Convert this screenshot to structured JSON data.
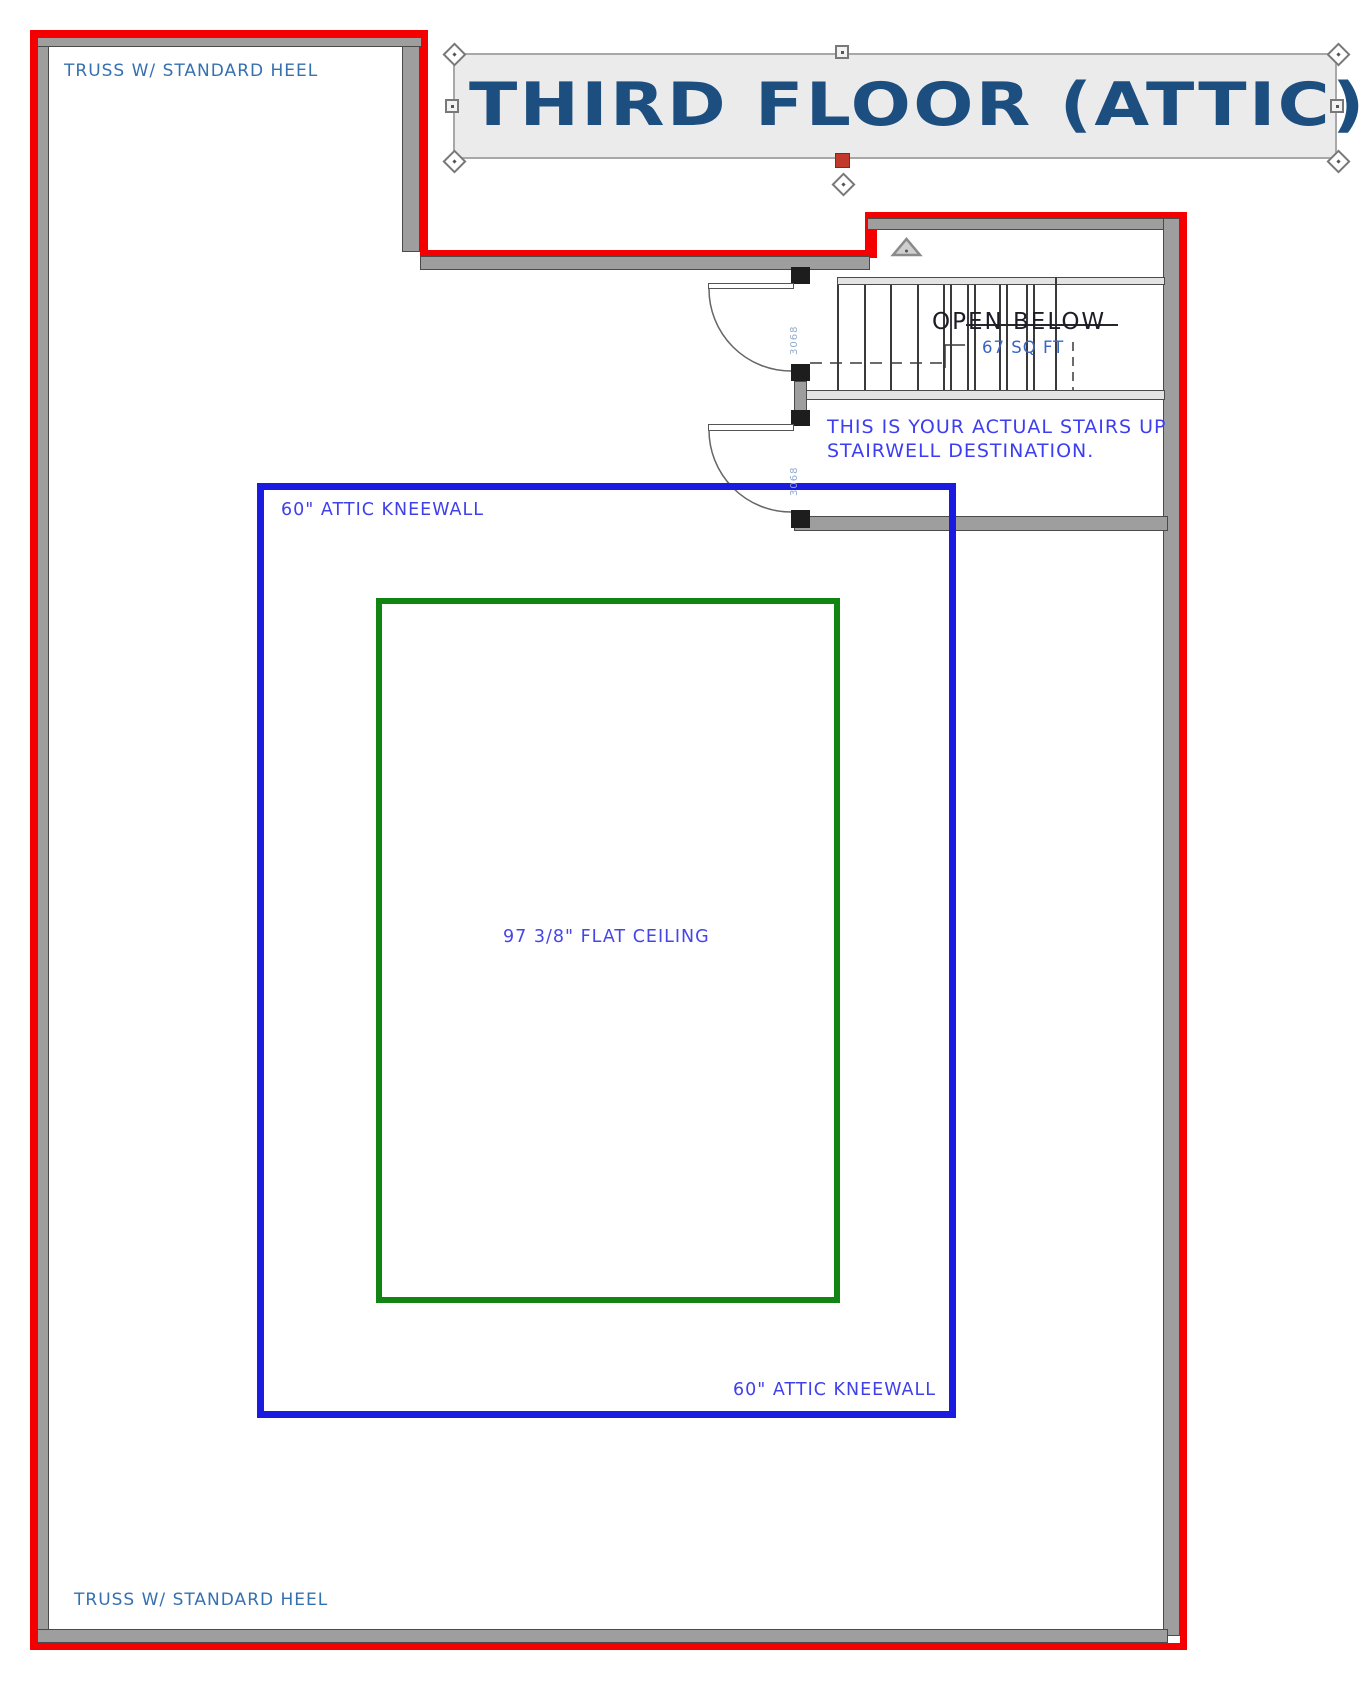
{
  "title": {
    "label": "THIRD FLOOR (ATTIC)"
  },
  "labels": {
    "truss_top": "TRUSS W/ STANDARD HEEL",
    "truss_bottom": "TRUSS W/ STANDARD HEEL",
    "kneewall_top": "60\" ATTIC KNEEWALL",
    "kneewall_bottom": "60\" ATTIC KNEEWALL",
    "flat_ceiling": "97 3/8\" FLAT CEILING",
    "open_below": "OPEN BELOW",
    "open_below_area": "67 SQ FT",
    "stairs_note_line1": "THIS IS YOUR ACTUAL STAIRS UP",
    "stairs_note_line2": "STAIRWELL DESTINATION.",
    "door_top_size": "3068",
    "door_bottom_size": "3068"
  },
  "colors": {
    "exterior_wall_red": "#f50000",
    "wall_fill_gray": "#9e9e9e",
    "kneewall_line_blue": "#1a1ae0",
    "ceiling_line_green": "#128412",
    "annotation_blue": "#3d3df2",
    "annotation_steel_blue": "#3570b0",
    "title_navy": "#1d4e80",
    "open_below_ink": "#1d1d28",
    "door_size_blue": "#92aacd"
  }
}
